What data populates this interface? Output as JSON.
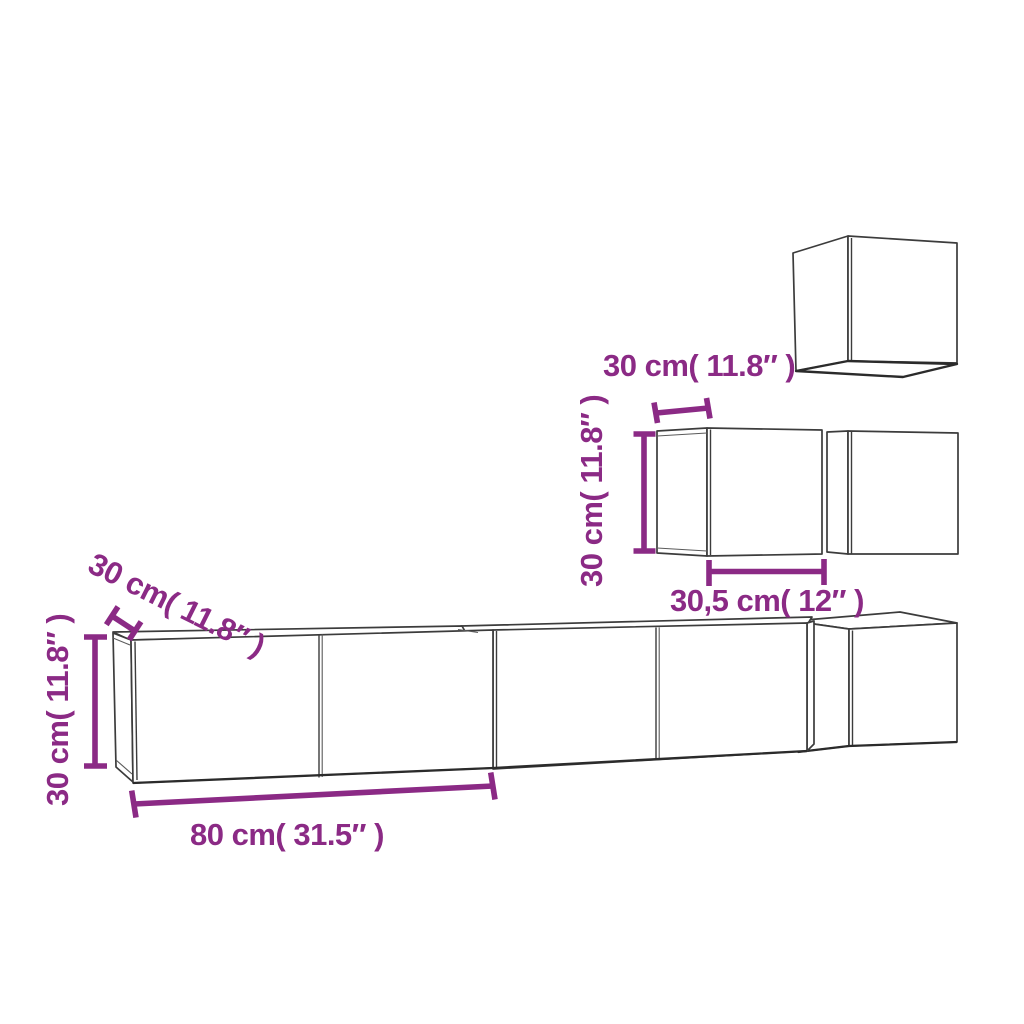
{
  "colors": {
    "dimension": "#8b2a85",
    "outline": "#3c3c3c",
    "background": "#ffffff"
  },
  "dimensions": {
    "top_cube_size_label": "30 cm( 11.8″ )",
    "mid_cabinet_height_label": "30 cm( 11.8″ )",
    "mid_cabinet_width_label": "30,5 cm( 12″ )",
    "long_cabinet_depth_label": "30 cm( 11.8″ )",
    "long_cabinet_height_label": "30 cm( 11.8″ )",
    "long_cabinet_width_label": "80 cm( 31.5″ )"
  }
}
